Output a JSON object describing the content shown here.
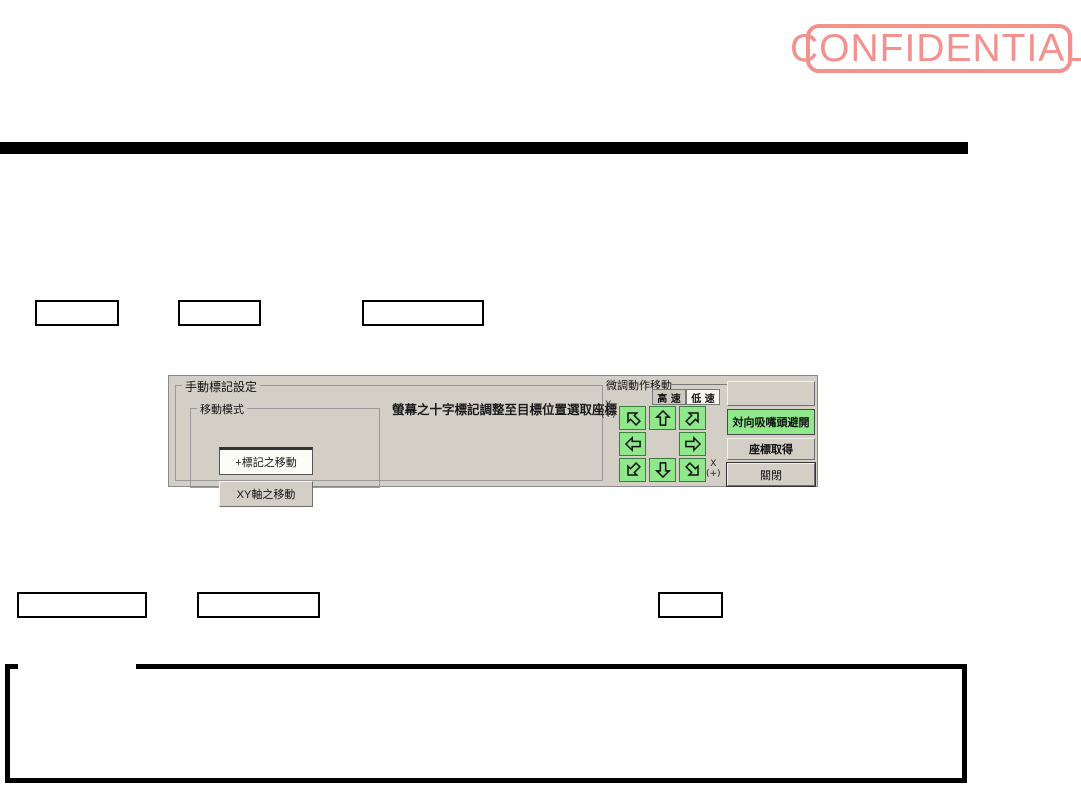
{
  "stamp": {
    "label": "CONFIDENTIAL",
    "color": "#f2918d"
  },
  "figure": {
    "manual_mark": {
      "title": "手動標記設定",
      "instruction": "螢幕之十字標記調整至目標位置選取座標",
      "move_mode": {
        "title": "移動模式",
        "mark_move_button": "+標記之移動",
        "xy_move_button": "XY軸之移動"
      }
    },
    "jog": {
      "title": "微調動作移動",
      "high_speed_tab": "高 速",
      "low_speed_tab": "低 速",
      "y_axis": "Y",
      "y_sign": "(+)",
      "x_axis": "X",
      "x_sign": "(+)",
      "arrows": [
        "up-left",
        "up",
        "up-right",
        "left",
        "right",
        "down-left",
        "down",
        "down-right"
      ]
    },
    "side_buttons": {
      "blank": "",
      "nozzle_avoid": "対向吸嘴頭避開",
      "get_coordinates": "座標取得",
      "close": "關閉"
    },
    "colors": {
      "panel_bg": "#d3cfc7",
      "jog_green": "#8fe98b"
    }
  }
}
